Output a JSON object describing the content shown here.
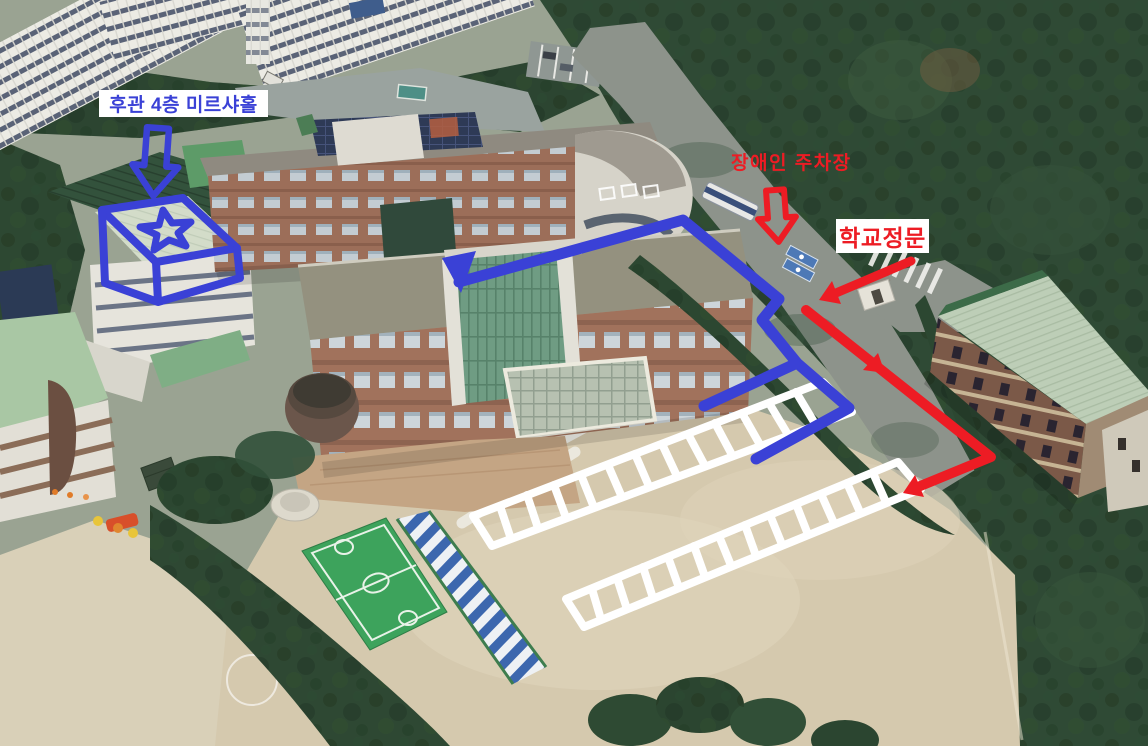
{
  "annotations": {
    "labels": [
      {
        "id": "hall-label",
        "text": "후관 4층 미르샤홀",
        "color": "#3A41D6",
        "background": "#FFFFFF"
      },
      {
        "id": "disabled-parking-label",
        "text": "장애인 주차장",
        "color": "#ED1C24",
        "background": null
      },
      {
        "id": "school-gate-label",
        "text": "학교정문",
        "color": "#ED1C24",
        "background": "#FFFFFF"
      }
    ],
    "colors": {
      "blue": "#3A41D6",
      "red": "#ED1C24",
      "white": "#FFFFFF"
    },
    "markers": [
      {
        "id": "destination-roof-box",
        "shape": "3d-box-with-star",
        "color": "#3A41D6"
      },
      {
        "id": "hall-down-arrow",
        "shape": "hollow-arrow-down",
        "color": "#3A41D6"
      },
      {
        "id": "disabled-parking-down-arrow",
        "shape": "hollow-arrow-down",
        "color": "#ED1C24"
      },
      {
        "id": "blue-route",
        "shape": "polyline-arrow",
        "color": "#3A41D6"
      },
      {
        "id": "gate-arrow",
        "shape": "line-arrow",
        "color": "#ED1C24"
      },
      {
        "id": "red-route",
        "shape": "polyline-arrow",
        "color": "#ED1C24"
      }
    ],
    "parking_rows": [
      {
        "id": "upper-parking-row",
        "spaces": 13,
        "color": "#FFFFFF"
      },
      {
        "id": "lower-parking-row",
        "spaces": 13,
        "color": "#FFFFFF"
      }
    ]
  },
  "scene": {
    "type": "aerial-3d-view",
    "subject": "school campus with apartments, forest, playground, gym"
  }
}
